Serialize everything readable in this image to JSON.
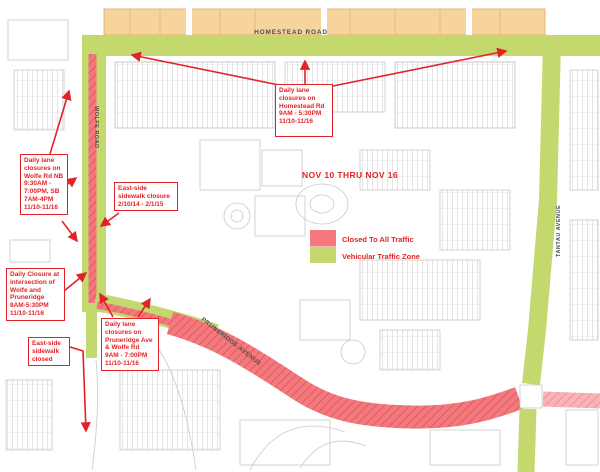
{
  "title": "NOV 10 THRU NOV 16",
  "roads": {
    "homestead": "HOMESTEAD ROAD",
    "wolfe": "WOLFE ROAD",
    "pruneridge": "PRUNERIDGE AVENUE",
    "tantau": "TANTAU AVENUE"
  },
  "legend": {
    "items": [
      {
        "label": "Closed To All Traffic",
        "color": "#f4787c"
      },
      {
        "label": "Vehicular Traffic Zone",
        "color": "#c3d86d"
      }
    ]
  },
  "notes": {
    "wolfe": "Daily lane closures on Wolfe Rd NB 9:30AM - 7:00PM, SB 7AM-4PM 11/10-11/16",
    "sidewalk_east_dates": "East-side sidewalk closure  2/10/14 - 2/1/15",
    "homestead": "Daily lane closures on Homestead Rd 9AM - 5:30PM 11/10-11/16",
    "intersection": "Daily Closure at intersection of Wolfe and Pruneridge 8AM-5:30PM 11/10-11/16",
    "sidewalk_closed": "East-side sidewalk closed",
    "pruneridge": "Daily lane closures on Pruneridge Ave & Wolfe Rd 9AM - 7:00PM 11/10-11/16"
  },
  "colors": {
    "closed_to_traffic": "#f4787c",
    "vehicular_zone": "#c3d86d",
    "annotation_red": "#e32228",
    "north_buildings_tan": "#f6d49c"
  }
}
